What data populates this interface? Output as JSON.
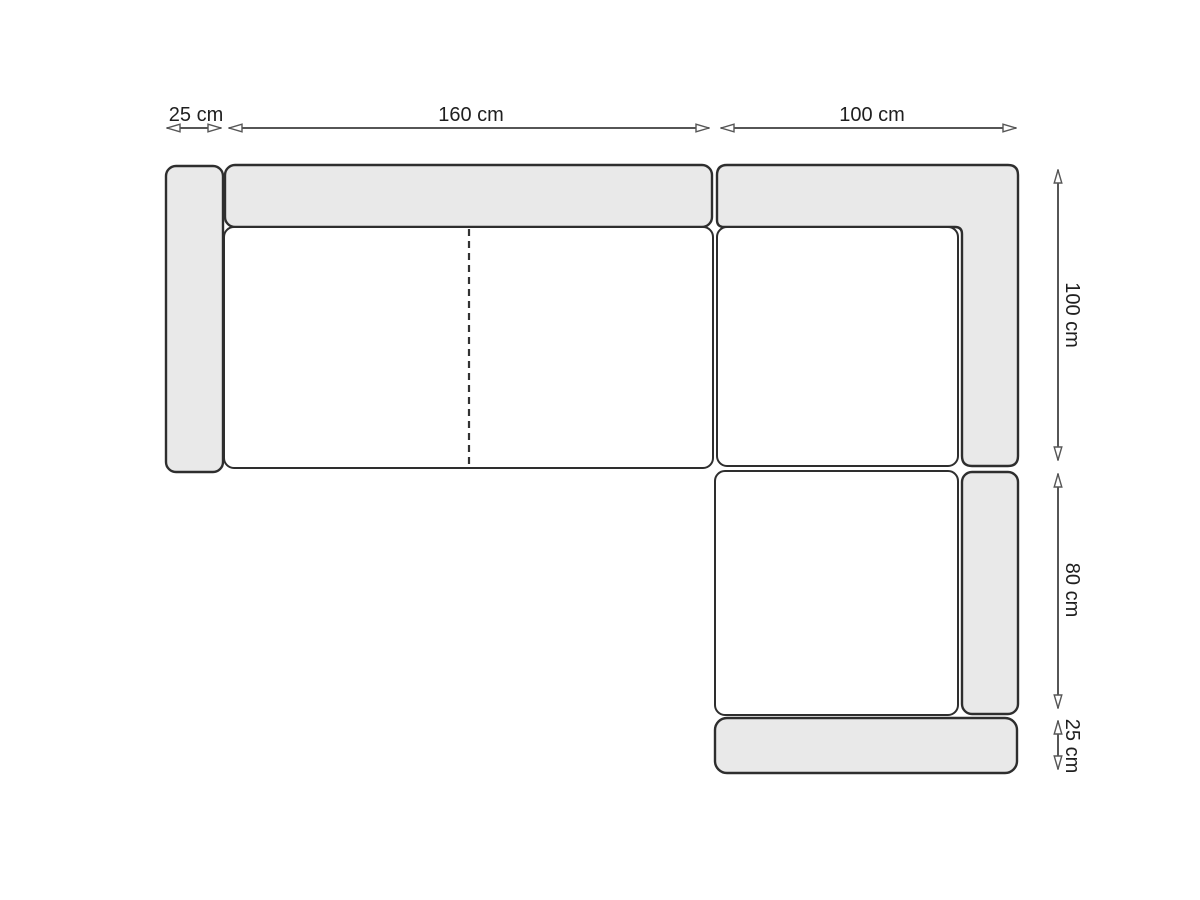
{
  "diagram": {
    "dimensions": {
      "top": [
        {
          "label": "25 cm"
        },
        {
          "label": "160 cm"
        },
        {
          "label": "100 cm"
        }
      ],
      "right": [
        {
          "label": "100 cm"
        },
        {
          "label": "80 cm"
        },
        {
          "label": "25 cm"
        }
      ]
    }
  },
  "colors": {
    "canvas-bg": "#ffffff",
    "cushion-fill": "#e9e9e9",
    "seat-fill": "#ffffff",
    "outline": "#2e2e2e",
    "dim-line": "#565656",
    "label-text": "#1f1f1f"
  }
}
